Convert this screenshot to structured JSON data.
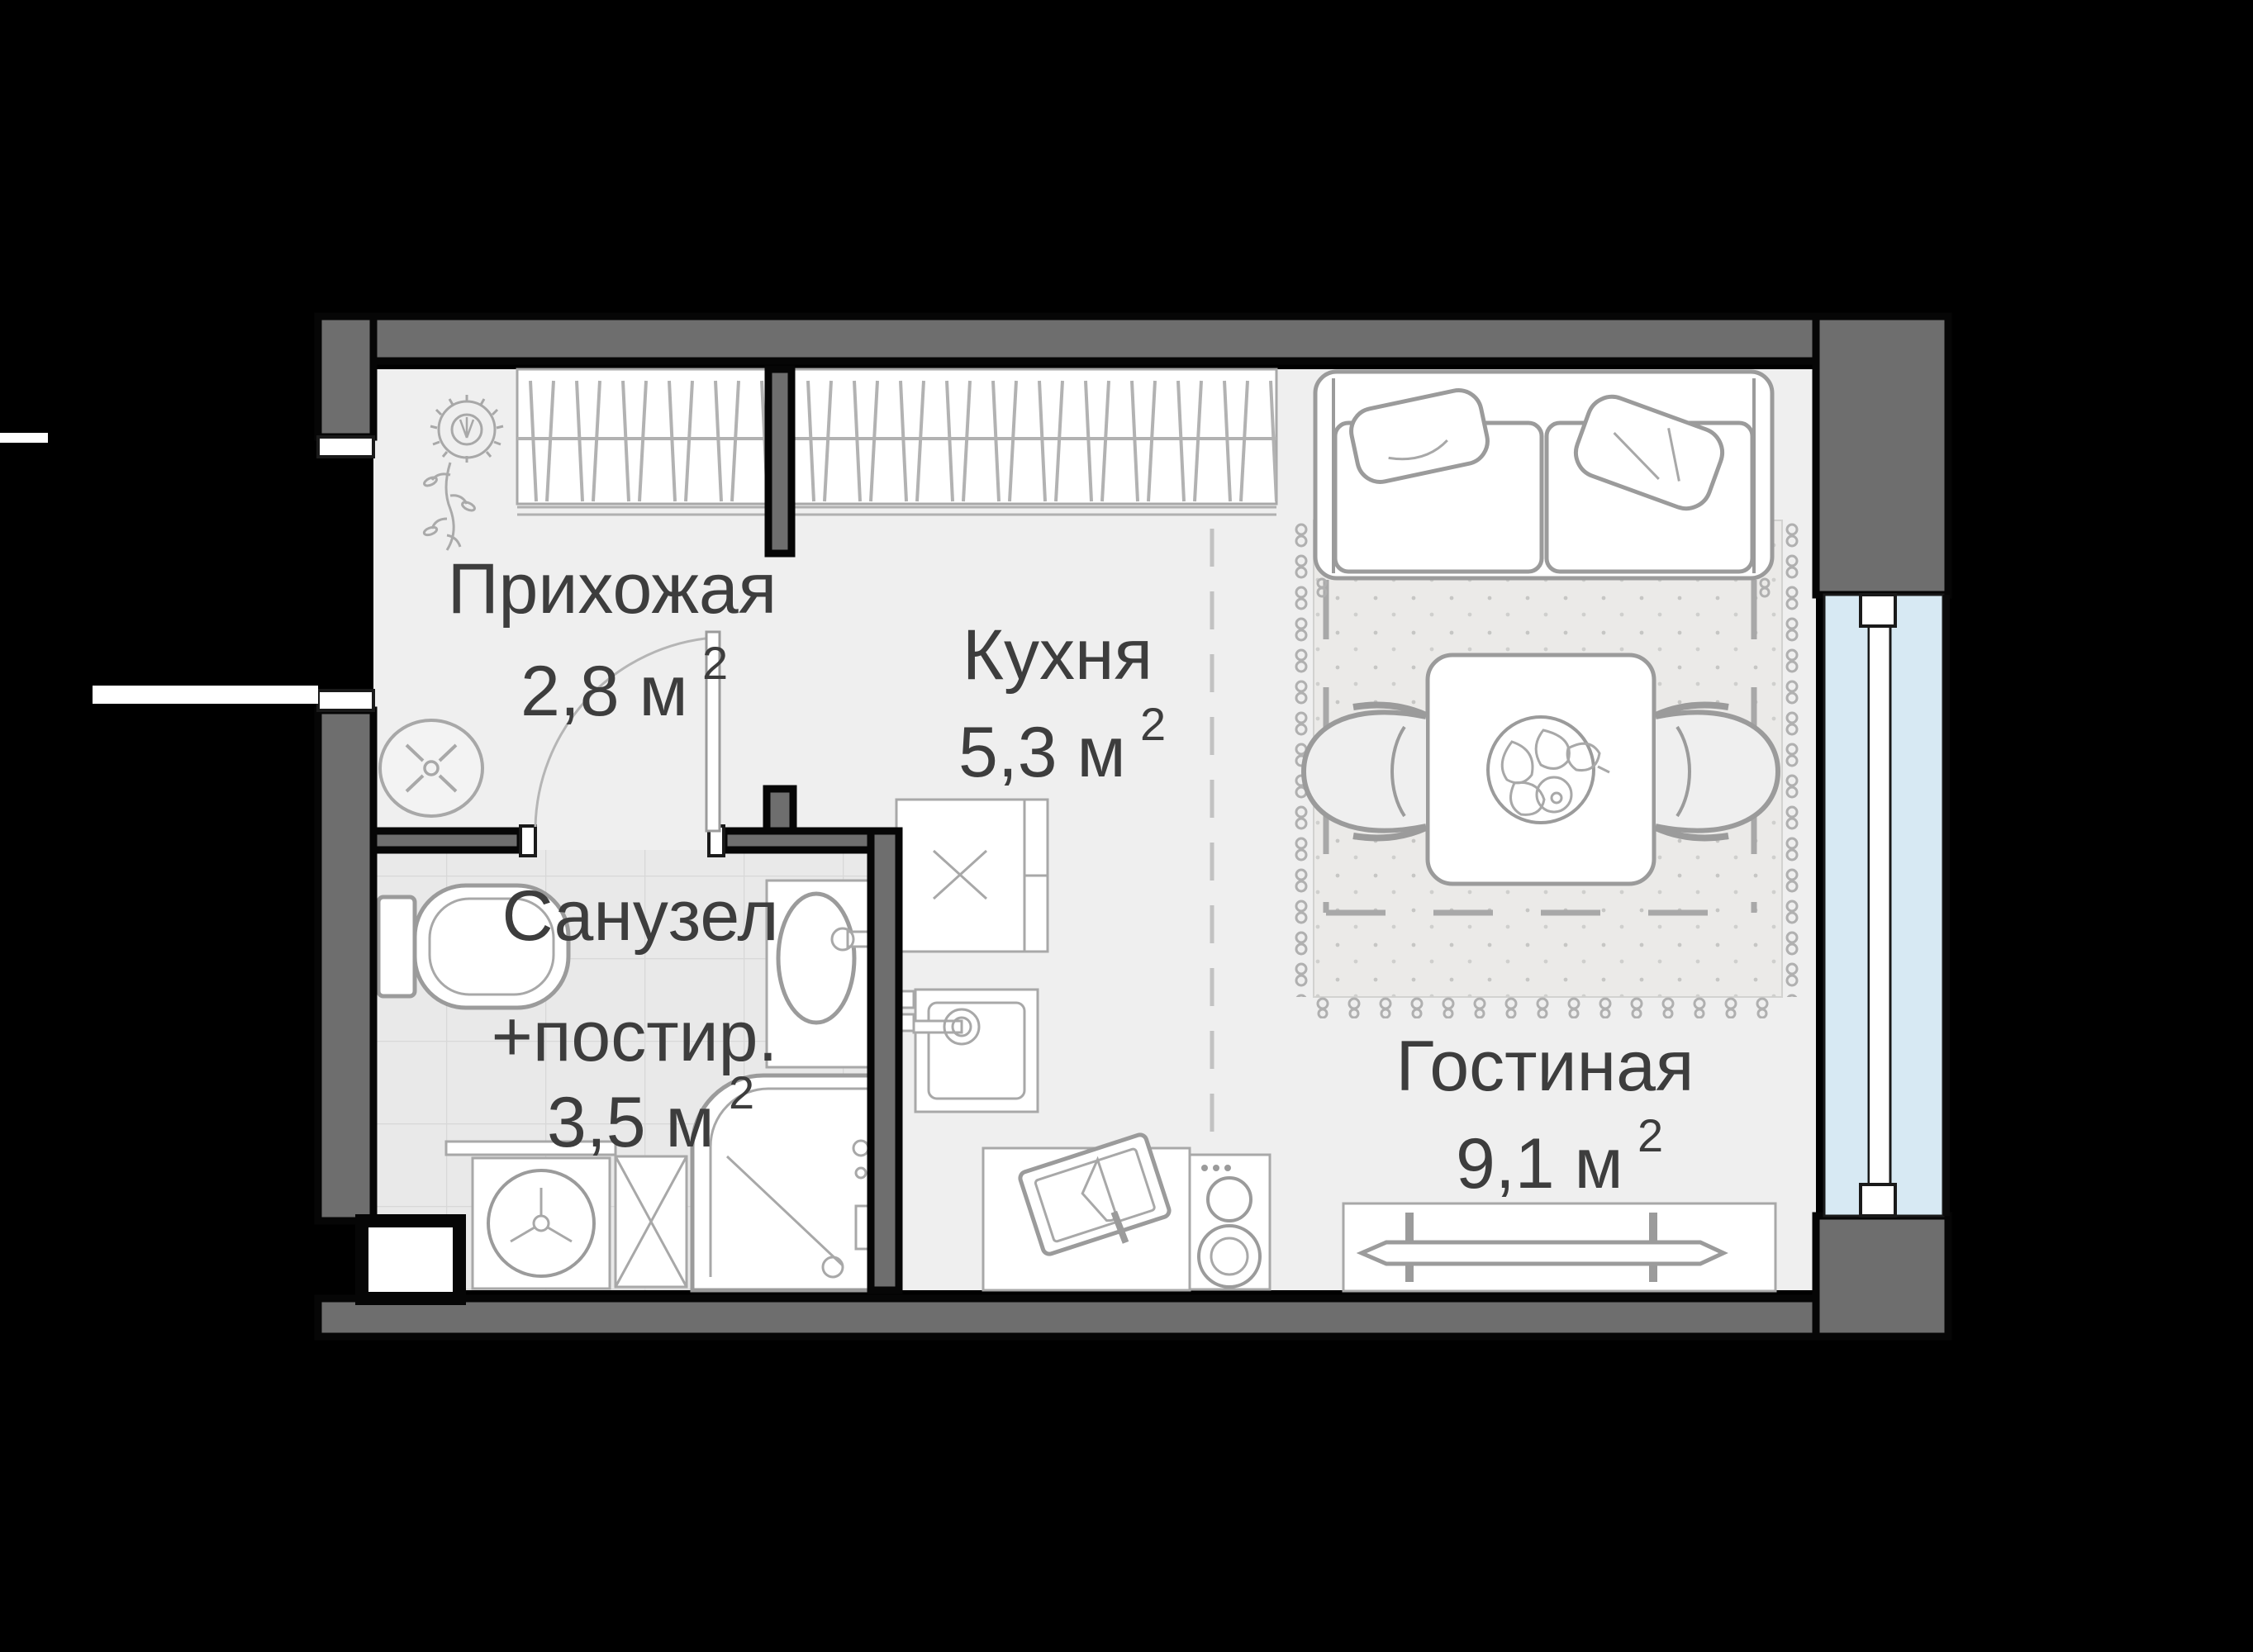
{
  "plan_title": "Studio apartment floor plan",
  "rooms": {
    "hallway": {
      "name": "Прихожая",
      "area": "2,8 м",
      "sup": "2"
    },
    "kitchen": {
      "name": "Кухня",
      "area": "5,3 м",
      "sup": "2"
    },
    "bathroom": {
      "name": "Санузел",
      "name2": "+постир.",
      "area": "3,5 м",
      "sup": "2"
    },
    "living": {
      "name": "Гостиная",
      "area": "9,1 м",
      "sup": "2"
    }
  },
  "colors": {
    "background": "#000000",
    "wall": "#6e6e6e",
    "floor": "#efefef",
    "bath_floor": "#e9e9e9",
    "rug": "#ebeae8",
    "glass": "#d7e9f3",
    "furniture_line": "#9b9b9b",
    "text": "#3d3d3d"
  }
}
